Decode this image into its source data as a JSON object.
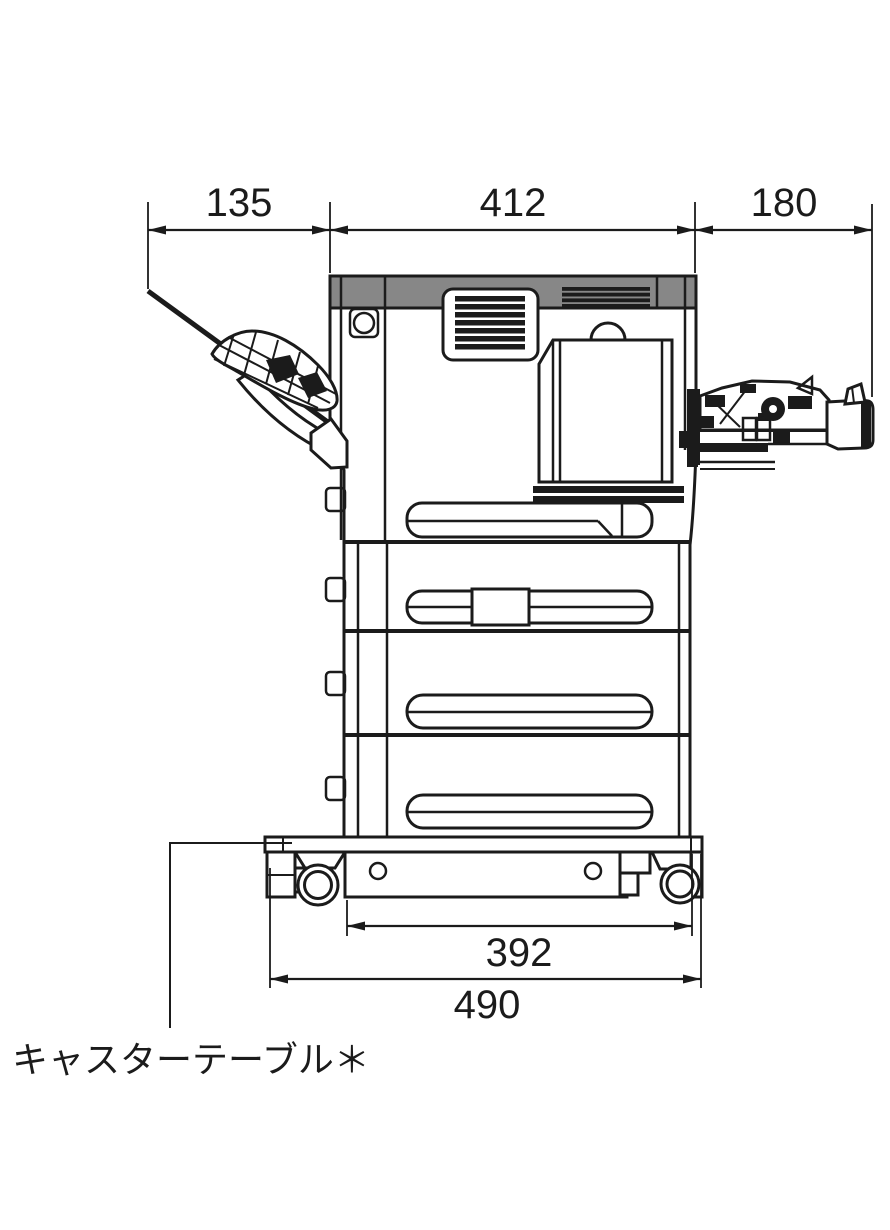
{
  "diagram": {
    "type": "printer-side-view-dimension-drawing",
    "caption": "キャスターテーブル＊",
    "dims": {
      "top_left": "135",
      "top_middle": "412",
      "top_right": "180",
      "bottom_inner": "392",
      "bottom_outer": "490"
    },
    "colors": {
      "line": "#1b1b1b",
      "panel_gray": "#878787",
      "background": "#ffffff"
    }
  }
}
